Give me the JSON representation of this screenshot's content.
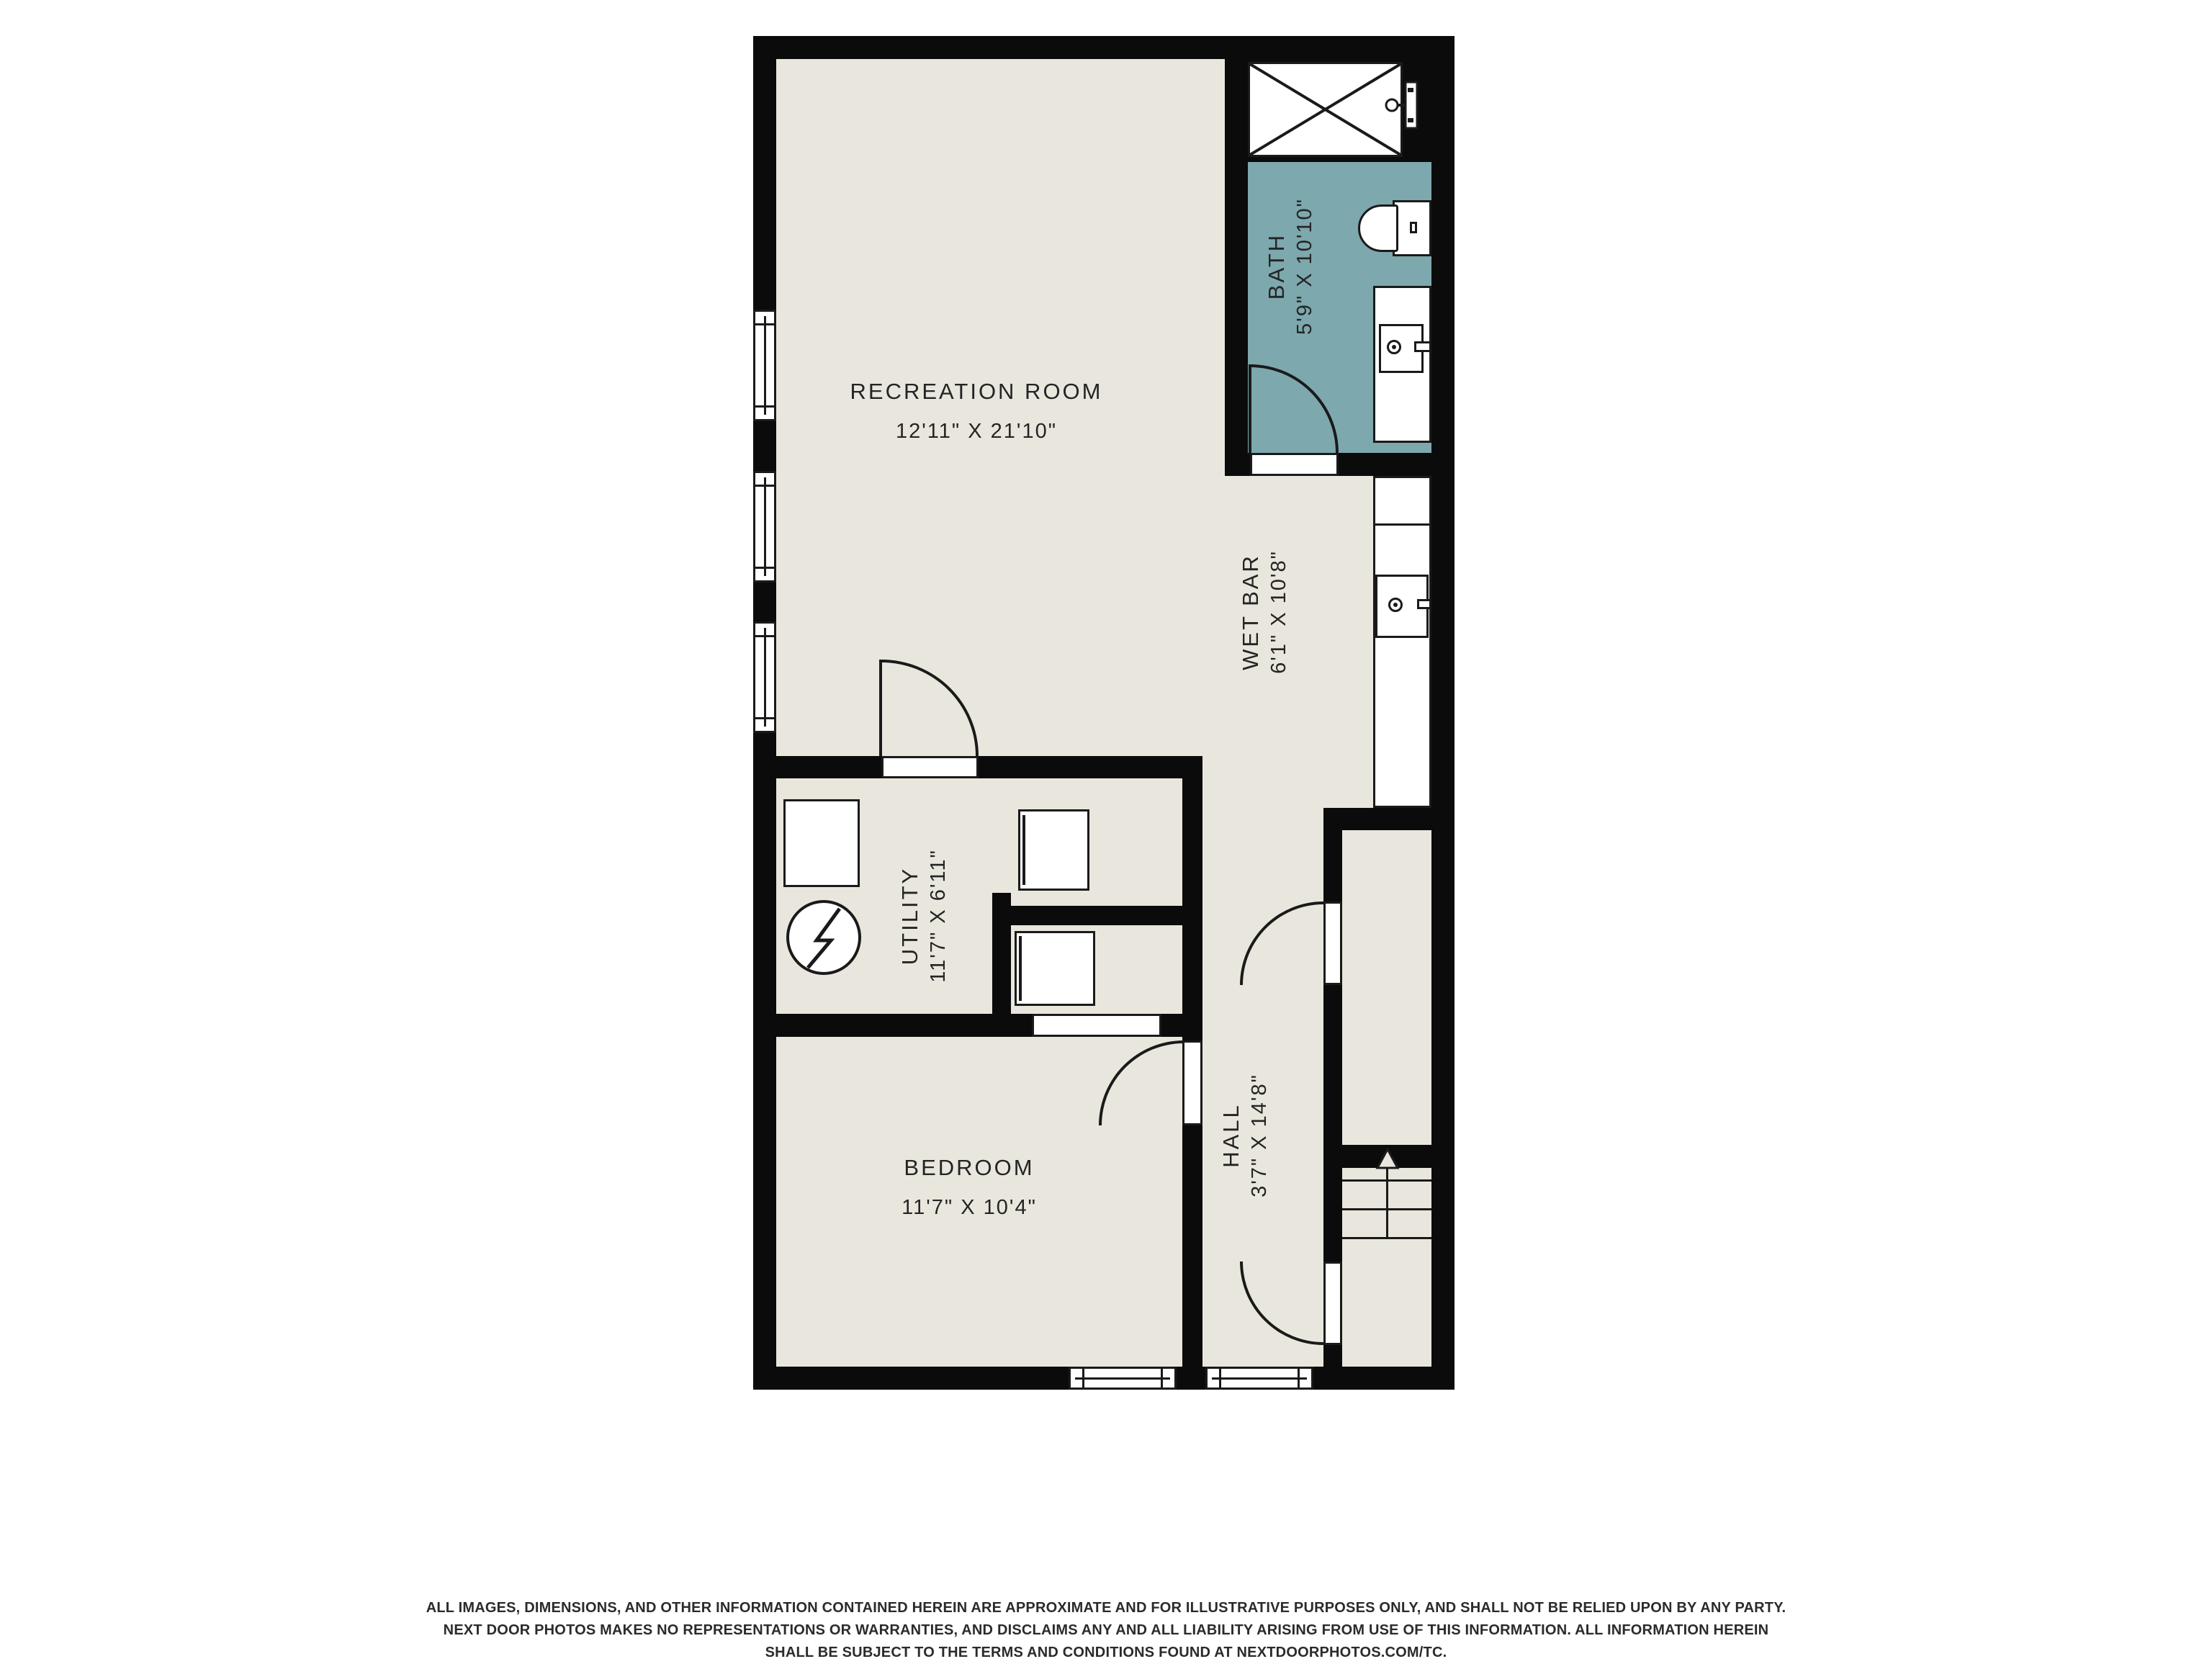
{
  "title": "Basement floor plan",
  "colors": {
    "background": "#ffffff",
    "wall": "#0b0b0b",
    "floor": "#e9e7dd",
    "bath_accent": "#7da8ad",
    "line": "#1a1a1a",
    "text": "#242424"
  },
  "rooms": {
    "recreation": {
      "name": "RECREATION ROOM",
      "dims": "12'11\" X 21'10\""
    },
    "bath": {
      "name": "BATH",
      "dims": "5'9\" X 10'10\""
    },
    "wet_bar": {
      "name": "WET BAR",
      "dims": "6'1\" X 10'8\""
    },
    "utility": {
      "name": "UTILITY",
      "dims": "11'7\" X 6'11\""
    },
    "bedroom": {
      "name": "BEDROOM",
      "dims": "11'7\" X 10'4\""
    },
    "hall": {
      "name": "HALL",
      "dims": "3'7\" X 14'8\""
    }
  },
  "icons": {
    "shower": "shower-pan-with-x",
    "shower_head": "shower-head-icon",
    "toilet": "toilet-icon",
    "bath_sink": "sink-faucet-icon",
    "wet_bar_sink": "sink-faucet-icon",
    "electrical": "electrical-panel-lightning-icon",
    "stairs": "stairs-up-arrow-icon"
  },
  "disclaimer": {
    "line1": "ALL IMAGES, DIMENSIONS, AND OTHER INFORMATION CONTAINED HEREIN ARE APPROXIMATE AND FOR ILLUSTRATIVE PURPOSES ONLY, AND SHALL NOT BE RELIED UPON BY ANY PARTY.",
    "line2": "NEXT DOOR PHOTOS MAKES NO REPRESENTATIONS OR WARRANTIES, AND DISCLAIMS ANY AND ALL LIABILITY ARISING FROM USE OF THIS INFORMATION. ALL INFORMATION HEREIN",
    "line3": "SHALL BE SUBJECT TO THE TERMS AND CONDITIONS FOUND AT NEXTDOORPHOTOS.COM/TC."
  }
}
